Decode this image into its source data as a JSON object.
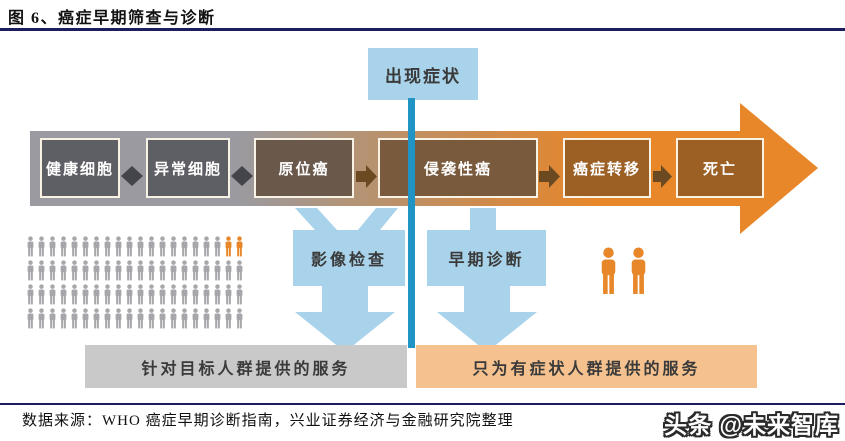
{
  "title": "图 6、癌症早期筛查与诊断",
  "symptom_box": "出现症状",
  "stages": [
    {
      "label": "健康细胞",
      "color": "#5e5e65"
    },
    {
      "label": "异常细胞",
      "color": "#5e5e65"
    },
    {
      "label": "原位癌",
      "color": "#6a584b"
    },
    {
      "label": "侵袭性癌",
      "color": "#7a5a3d"
    },
    {
      "label": "癌症转移",
      "color": "#9c5f24"
    },
    {
      "label": "死亡",
      "color": "#9c5f24"
    }
  ],
  "interventions": [
    {
      "label": "影像检查"
    },
    {
      "label": "早期诊断"
    }
  ],
  "service_bars": {
    "left": "针对目标人群提供的服务",
    "right": "只为有症状人群提供的服务"
  },
  "crowd": {
    "rows": [
      {
        "count": 20,
        "orange_last": 2
      },
      {
        "count": 20,
        "orange_last": 0
      },
      {
        "count": 20,
        "orange_last": 0
      },
      {
        "count": 20,
        "orange_last": 0
      }
    ]
  },
  "couple_count": 2,
  "footer": {
    "source": "数据来源：WHO 癌症早期诊断指南，兴业证券经济与金融研究院整理"
  },
  "watermark": "头条 @未来智库",
  "colors": {
    "accent_orange": "#e8872a",
    "band_gray": "#9a9aa0",
    "band_tan": "#b29478",
    "band_mid": "#cf8a4a",
    "light_blue": "#a9d3ea",
    "teal_line": "#2095c5",
    "bar_gray": "#c9c9c9",
    "bar_orange": "#f5c28f",
    "crowd_gray": "#a7a7ab",
    "connector_dark": "#44444b",
    "connector_brown": "#6b4a22",
    "underline_navy": "#1c1c60"
  }
}
